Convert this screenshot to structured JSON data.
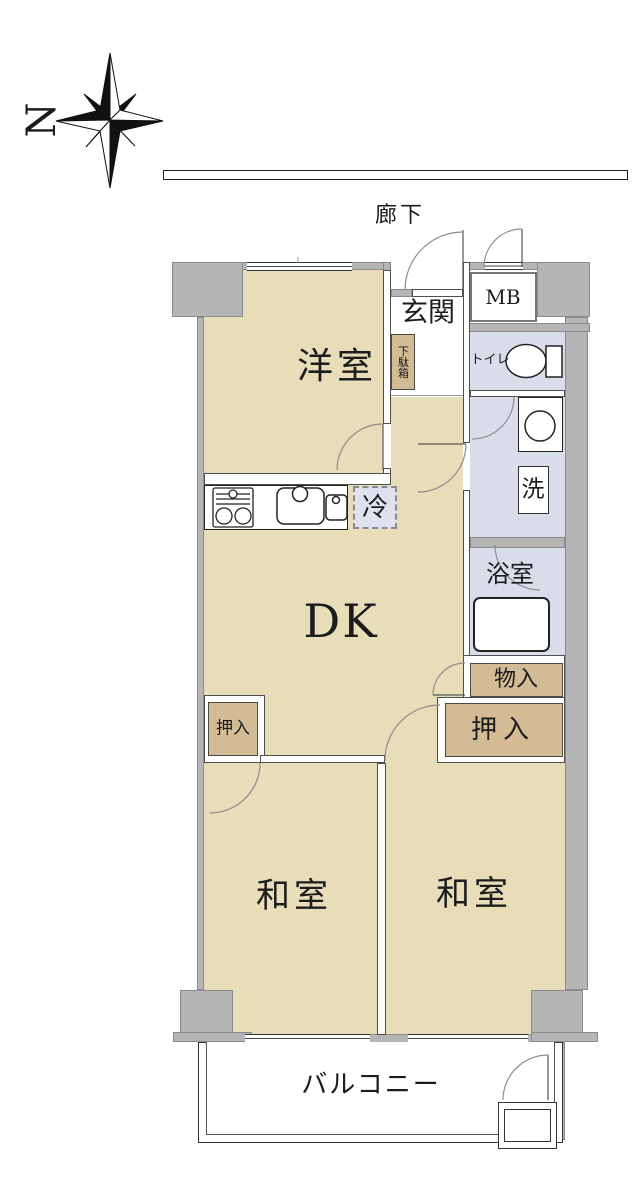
{
  "compass": {
    "north": "N"
  },
  "labels": {
    "corridor": "廊下",
    "entrance": "玄関",
    "meter_box": "MB",
    "toilet": "トイレ",
    "shoe_cabinet": "下駄箱",
    "western_room": "洋室",
    "refrigerator": "冷",
    "washer": "洗",
    "bathroom": "浴室",
    "dining_kitchen": "DK",
    "storage": "物入",
    "closet_right": "押入",
    "closet_left": "押入",
    "japanese_room_left": "和室",
    "japanese_room_right": "和室",
    "balcony": "バルコニー"
  },
  "colors": {
    "floor_beige": "#e8ddb9",
    "closet_tan": "#d2bb95",
    "wet_area_lavender": "#d9dce9",
    "wall_gray": "#b5b5b6",
    "refrigerator_fill": "#dfe2ee"
  }
}
